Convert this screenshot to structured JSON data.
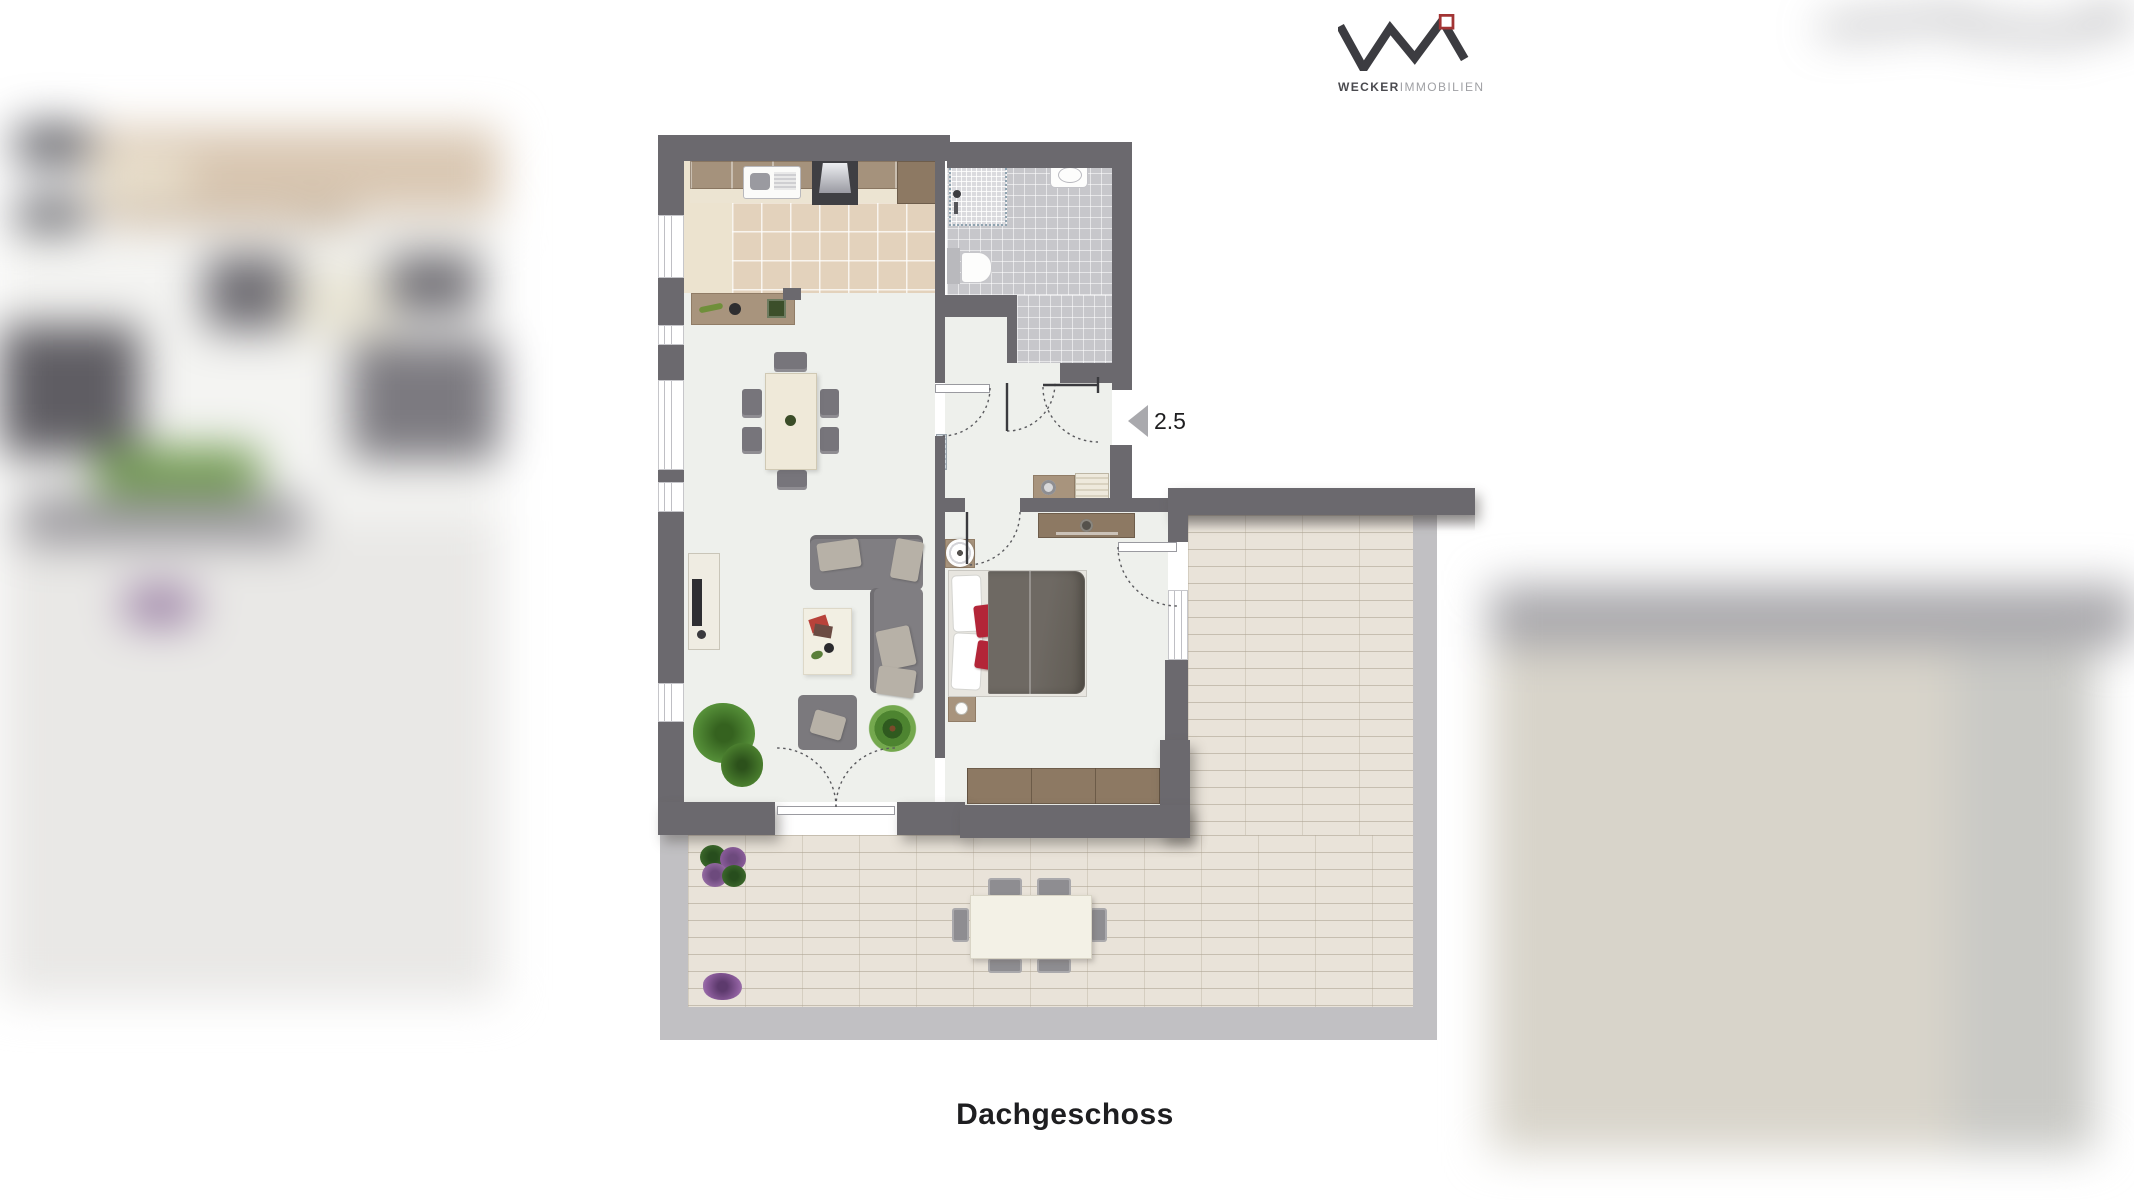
{
  "page": {
    "caption": "Dachgeschoss"
  },
  "logo": {
    "brand_bold": "WECKER",
    "brand_light": "IMMOBILIEN"
  },
  "plan": {
    "entrance_label": "2.5"
  },
  "colors": {
    "wall": "#6b696e",
    "floor": "#eef0ec",
    "kitchen_floor": "#ece3cf",
    "kitchen_tile": "#e3d2bc",
    "bath_tile": "#c7c7cb",
    "shower_tile": "#dadade",
    "terrace_brick": "#e9e3d9",
    "terrace_border": "#c1c0c3",
    "wood": "#a8947d",
    "wood_dark": "#8d7963",
    "sofa": "#807e82",
    "cushion": "#b7b1a7",
    "bed_duvet": "#6e6963",
    "accent_red": "#b32538",
    "plant_green": "#55883a",
    "flower_purple": "#8f5f9f",
    "arrow_gray": "#a9a9ad",
    "text_dark": "#1e1e20",
    "logo_dark": "#3c3c41",
    "logo_light": "#9fa0a4",
    "logo_red": "#a23434"
  }
}
